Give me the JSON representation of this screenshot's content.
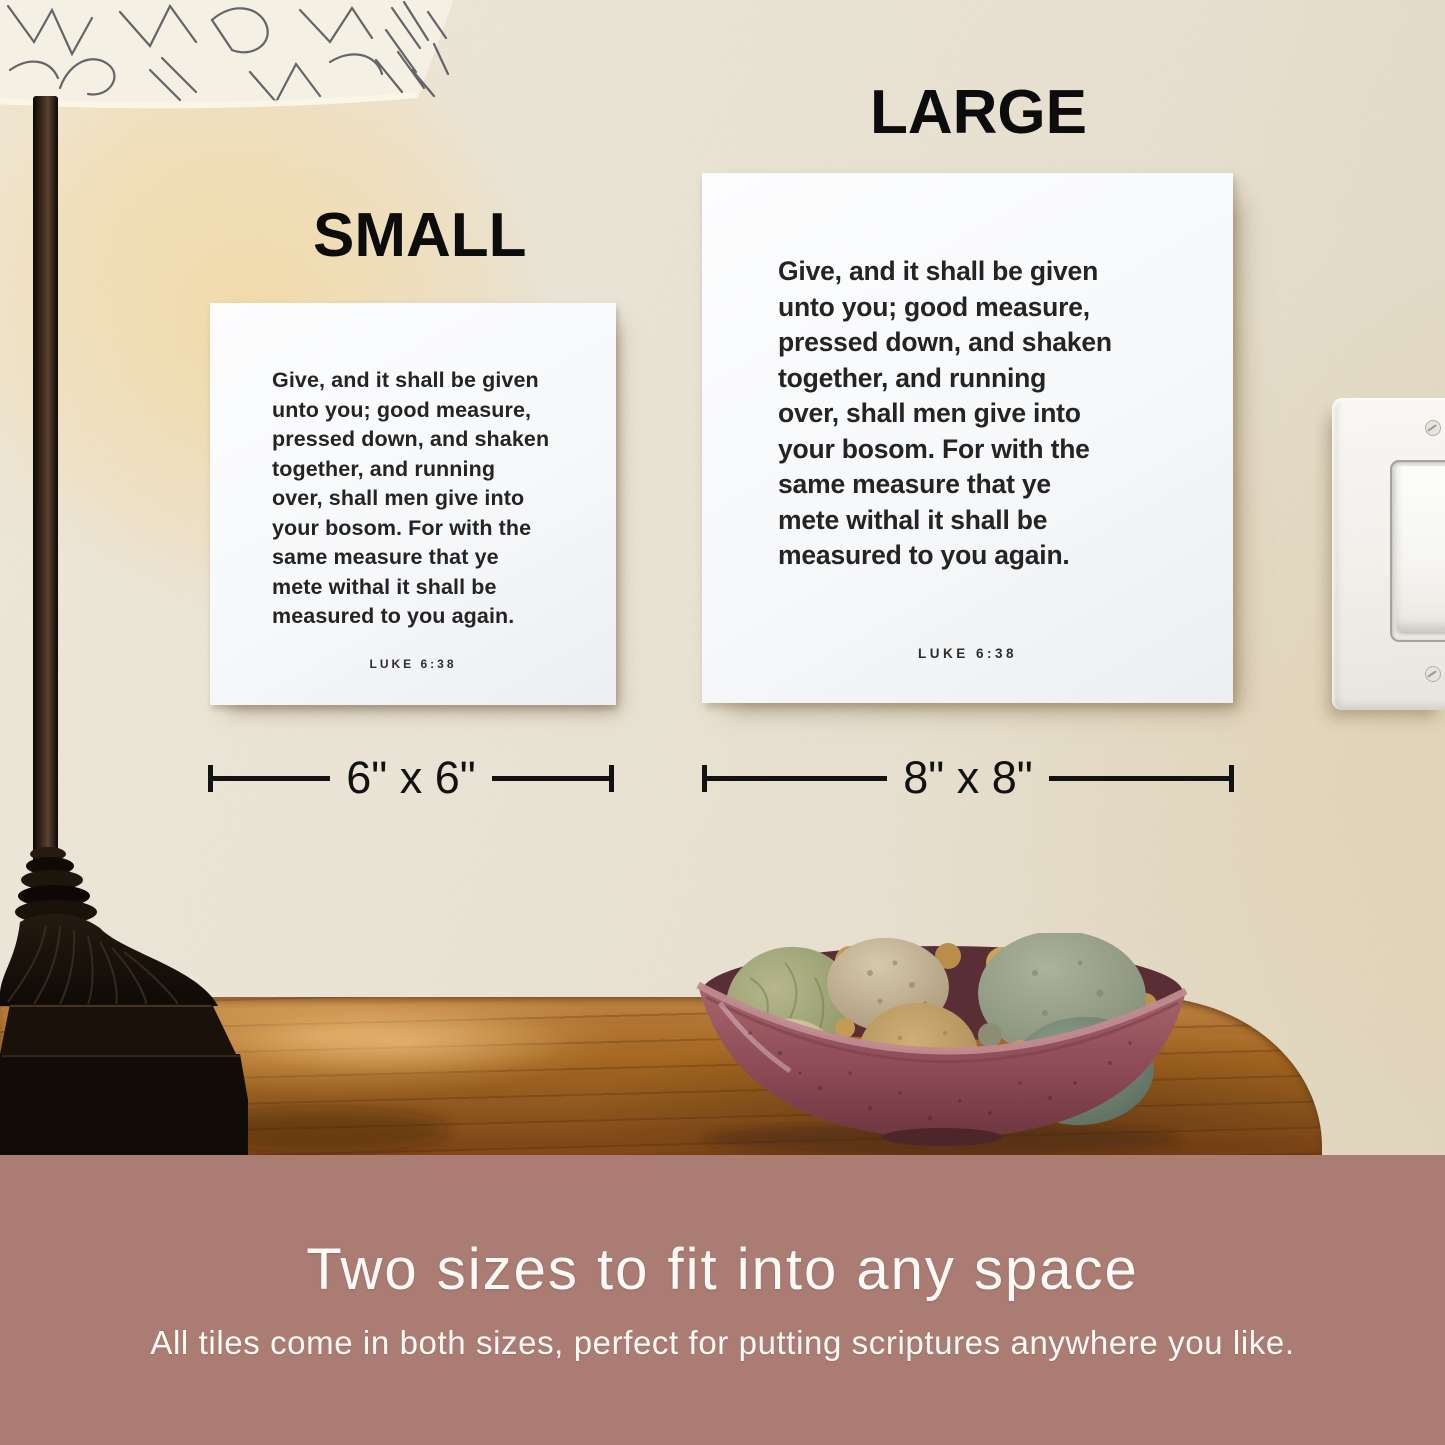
{
  "scene": {
    "label_small": "SMALL",
    "label_large": "LARGE",
    "dimension_small": "6\" x 6\"",
    "dimension_large": "8\" x 8\"",
    "scripture_lines": [
      "Give, and it shall be given",
      "unto you; good measure,",
      "pressed down, and shaken",
      "together, and running",
      "over, shall men give into",
      "your bosom. For with the",
      "same measure that ye",
      "mete withal it shall be",
      "measured to you again."
    ],
    "scripture_reference": "LUKE 6:38",
    "objects": [
      "table-lamp",
      "patterned-lampshade",
      "scripture-tile-small",
      "scripture-tile-large",
      "light-switch",
      "wood-table",
      "bowl-of-stones"
    ]
  },
  "banner": {
    "heading": "Two sizes to fit into any space",
    "subheading": "All tiles come in both sizes, perfect for putting scriptures anywhere you like."
  },
  "colors": {
    "banner_bg": "#ab7c73",
    "wall": "#ebe4d5",
    "glow": "#f6d694",
    "wood": "#a4661f",
    "bowl": "#8e505a",
    "tile": "#f7f8fa",
    "tile_text": "#242424",
    "annotation_text": "#121212",
    "banner_text": "#fdfaf7"
  }
}
